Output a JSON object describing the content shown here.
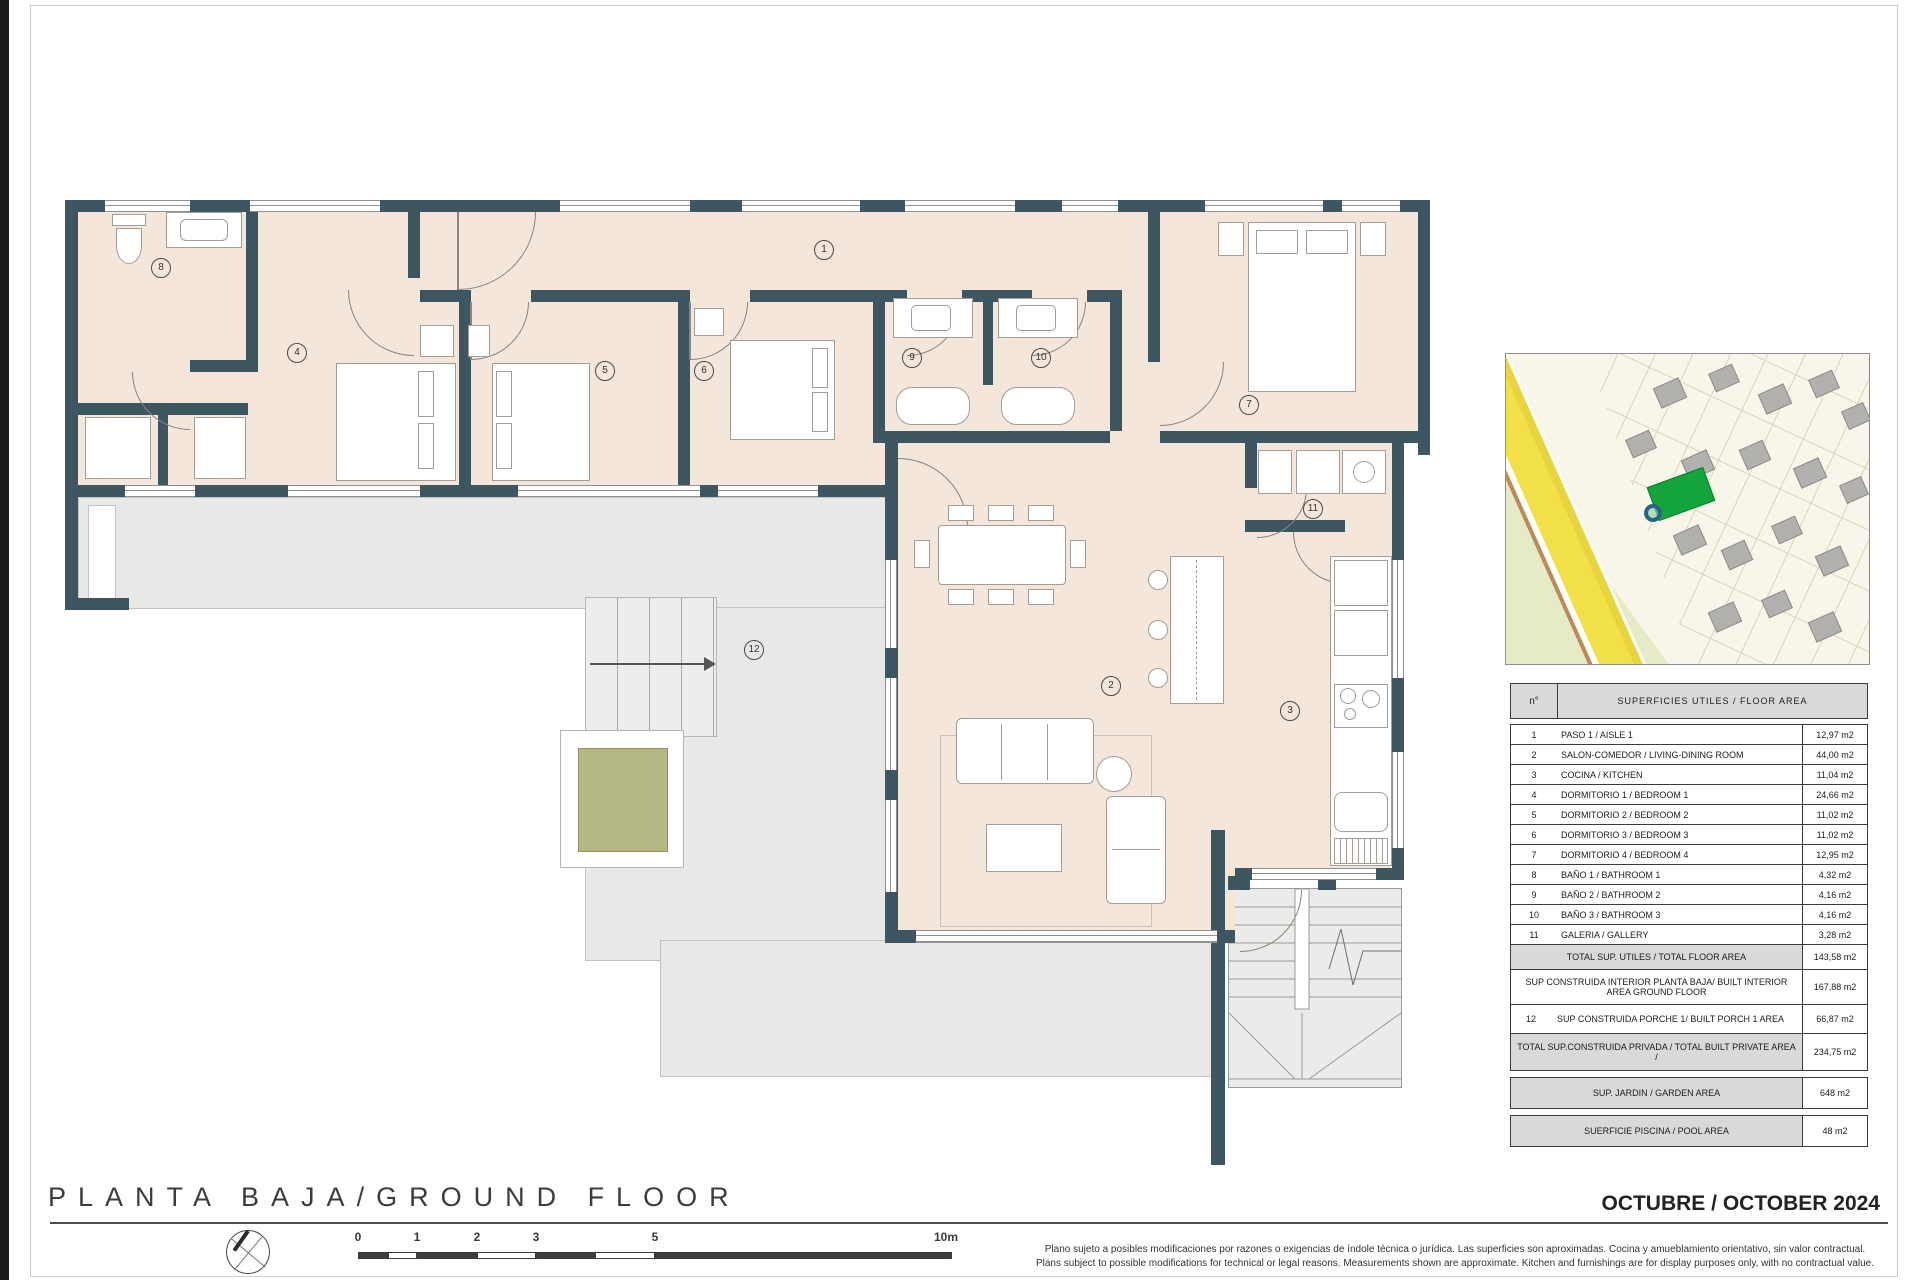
{
  "plan": {
    "room_labels": [
      "1",
      "2",
      "3",
      "4",
      "5",
      "6",
      "7",
      "8",
      "9",
      "10",
      "11",
      "12"
    ]
  },
  "table": {
    "header_no": "n°",
    "header_title": "SUPERFICIES UTILES / FLOOR AREA",
    "rows": [
      {
        "no": "1",
        "name": "PASO 1 / AISLE 1",
        "area": "12,97 m2"
      },
      {
        "no": "2",
        "name": "SALON-COMEDOR / LIVING-DINING ROOM",
        "area": "44,00 m2"
      },
      {
        "no": "3",
        "name": "COCINA / KITCHEN",
        "area": "11,04 m2"
      },
      {
        "no": "4",
        "name": "DORMITORIO 1 / BEDROOM 1",
        "area": "24,66 m2"
      },
      {
        "no": "5",
        "name": "DORMITORIO 2 / BEDROOM 2",
        "area": "11,02 m2"
      },
      {
        "no": "6",
        "name": "DORMITORIO 3 / BEDROOM 3",
        "area": "11,02 m2"
      },
      {
        "no": "7",
        "name": "DORMITORIO 4 / BEDROOM 4",
        "area": "12,95 m2"
      },
      {
        "no": "8",
        "name": "BAÑO 1 / BATHROOM 1",
        "area": "4,32 m2"
      },
      {
        "no": "9",
        "name": "BAÑO 2 / BATHROOM 2",
        "area": "4,16 m2"
      },
      {
        "no": "10",
        "name": "BAÑO 3 / BATHROOM 3",
        "area": "4,16 m2"
      },
      {
        "no": "11",
        "name": "GALERIA / GALLERY",
        "area": "3,28 m2"
      }
    ],
    "total_floor": {
      "name": "TOTAL SUP. UTILES / TOTAL FLOOR AREA",
      "area": "143,58 m2"
    },
    "built_interior": {
      "name": "SUP CONSTRUIDA INTERIOR PLANTA BAJA/ BUILT INTERIOR AREA GROUND FLOOR",
      "area": "167,88 m2"
    },
    "porch": {
      "no": "12",
      "name": "SUP CONSTRUIDA PORCHE 1/ BUILT PORCH 1 AREA",
      "area": "66,87 m2"
    },
    "total_private": {
      "name": "TOTAL SUP.CONSTRUIDA PRIVADA / TOTAL  BUILT PRIVATE AREA /",
      "area": "234,75 m2"
    },
    "garden": {
      "name": "SUP. JARDIN / GARDEN AREA",
      "area": "648 m2"
    },
    "pool": {
      "name": "SUERFICIE PISCINA / POOL AREA",
      "area": "48 m2"
    }
  },
  "footer": {
    "title": "PLANTA BAJA/GROUND FLOOR",
    "date": "OCTUBRE / OCTOBER 2024",
    "disclaimer_es": "Plano sujeto a posibles modificaciones por razones o exigencias de índole técnica o jurídica. Las superficies son aproximadas. Cocina y amueblamiento orientativo, sin valor contractual.",
    "disclaimer_en": "Plans subject to possible modifications for technical or legal reasons. Measurements shown are approximate. Kitchen and furnishings are for display purposes only, with no contractual value."
  },
  "scale": {
    "ticks": [
      "0",
      "1",
      "2",
      "3",
      "5",
      "10m"
    ]
  },
  "colors": {
    "wall": "#3e5562",
    "floor": "#f4e6da",
    "terrace": "#e8e8e6",
    "planter": "#b5b884",
    "table_shade": "#d9d9d8",
    "map_plot_green": "#14a43c",
    "map_road_yellow": "#f2e049",
    "map_park": "#e7eac6"
  }
}
